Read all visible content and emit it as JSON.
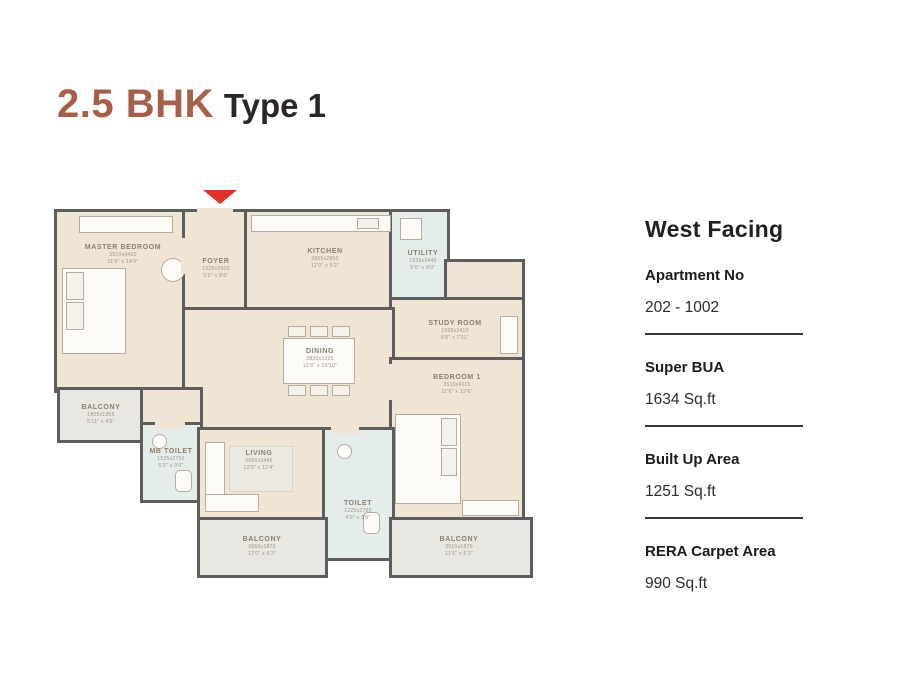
{
  "title": {
    "accent": "2.5 BHK",
    "suffix": "Type 1"
  },
  "info_panel": {
    "heading": "West Facing",
    "fields": [
      {
        "label": "Apartment No",
        "value": "202 - 1002"
      },
      {
        "label": "Super BUA",
        "value": "1634 Sq.ft"
      },
      {
        "label": "Built Up Area",
        "value": "1251 Sq.ft"
      },
      {
        "label": "RERA Carpet Area",
        "value": "990 Sq.ft"
      }
    ]
  },
  "floorplan": {
    "entry_marker": "entry-arrow",
    "rooms": [
      {
        "name": "MASTER BEDROOM",
        "dim_mm": "3510x4420",
        "dim_ft": "11'6\" x 14'6\""
      },
      {
        "name": "FOYER",
        "dim_mm": "1520x2600",
        "dim_ft": "5'0\" x 8'6\""
      },
      {
        "name": "KITCHEN",
        "dim_mm": "3665x2800",
        "dim_ft": "12'0\" x 9'2\""
      },
      {
        "name": "UTILITY",
        "dim_mm": "1535x2440",
        "dim_ft": "5'0\" x 8'0\""
      },
      {
        "name": "STUDY ROOM",
        "dim_mm": "1825x2410",
        "dim_ft": "6'0\" x 7'11\""
      },
      {
        "name": "DINING",
        "dim_mm": "3820x3295",
        "dim_ft": "12'6\" x 10'10\""
      },
      {
        "name": "BEDROOM 1",
        "dim_mm": "3510x4115",
        "dim_ft": "11'6\" x 13'6\""
      },
      {
        "name": "BALCONY",
        "dim_mm": "1805x1365",
        "dim_ft": "5'11\" x 4'6\""
      },
      {
        "name": "MB TOILET",
        "dim_mm": "1525x2750",
        "dim_ft": "5'0\" x 9'0\""
      },
      {
        "name": "LIVING",
        "dim_mm": "3660x3445",
        "dim_ft": "12'0\" x 11'4\""
      },
      {
        "name": "TOILET",
        "dim_mm": "1225x2750",
        "dim_ft": "4'0\" x 9'0\""
      },
      {
        "name": "BALCONY",
        "dim_mm": "3660x1870",
        "dim_ft": "12'0\" x 6'2\""
      },
      {
        "name": "BALCONY",
        "dim_mm": "3510x1870",
        "dim_ft": "11'6\" x 6'2\""
      }
    ]
  },
  "colors": {
    "title_accent": "#A75F4A",
    "text_dark": "#2a2726",
    "wall": "#5d5d5d",
    "floor_beige": "#F0E5D4",
    "balcony_gray": "#E8E7E2",
    "wet_area_green": "#E4EDE9",
    "entry_arrow_red": "#E03228"
  }
}
